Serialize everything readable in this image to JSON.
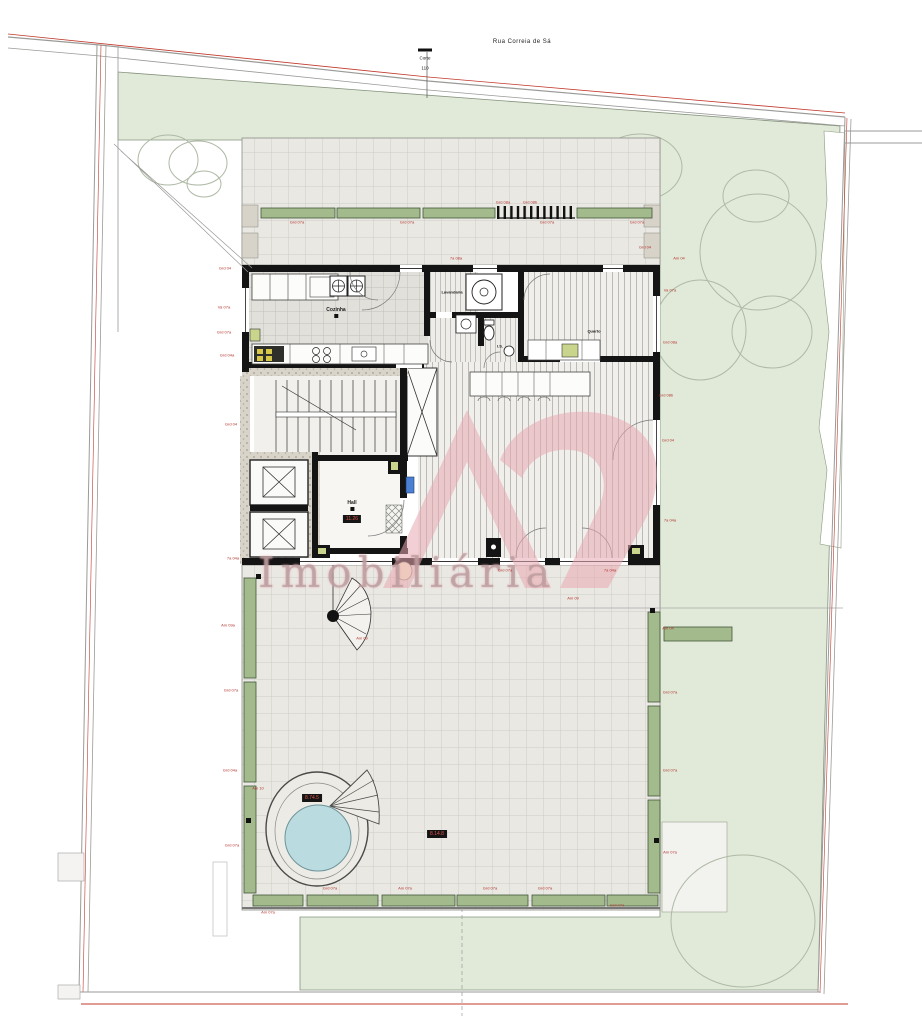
{
  "header": {
    "street_name": "Rua Correia de Sá",
    "section_marker": {
      "label": "Corte",
      "number": "110"
    }
  },
  "watermark": {
    "logo": "AS",
    "text": "Imobiliária",
    "color": "#e8a7b0"
  },
  "rooms": {
    "kitchen": "Cozinha",
    "laundry": "Lavandaria",
    "bedroom": "Quarto",
    "hall": "Hall",
    "wc": "I.S."
  },
  "boxed_labels": {
    "hall_area": "11.26",
    "pool_deck": "8.74.5",
    "terrace": "8.14.8"
  },
  "colors": {
    "garden_green": "#e1ead9",
    "planter_green": "#a3ba8c",
    "tile_grey": "#eae8e3",
    "wall_black": "#141414",
    "boundary_red": "#c0392b",
    "pool_water": "#badbdf",
    "dim_red": "#b3342e",
    "watermark_pink": "#e8a7b0"
  },
  "dims": [
    {
      "text": "Grd 04"
    },
    {
      "text": "Va 07a"
    },
    {
      "text": "Grd 07a"
    },
    {
      "text": "Grd 04a"
    },
    {
      "text": "Grd 04"
    },
    {
      "text": "7a 04a"
    },
    {
      "text": "Grd 07a"
    },
    {
      "text": "Grd 07a"
    },
    {
      "text": "Grd 08a"
    },
    {
      "text": "Grd 07a"
    },
    {
      "text": "Grd 07a"
    },
    {
      "text": "Grd 04"
    },
    {
      "text": "7a 08a"
    },
    {
      "text": "Am 04"
    },
    {
      "text": "Va 07a"
    },
    {
      "text": "Grd 08a"
    },
    {
      "text": "Grd 08b"
    },
    {
      "text": "Grd 04"
    },
    {
      "text": "7a 04a"
    },
    {
      "text": "7a 04a"
    },
    {
      "text": "Grd 07a"
    },
    {
      "text": "Am 09a"
    },
    {
      "text": "Grd 07a"
    },
    {
      "text": "Grd 04a"
    },
    {
      "text": "Grd 07a"
    },
    {
      "text": "Am 10"
    },
    {
      "text": "Grd 07a"
    },
    {
      "text": "Am 07a"
    },
    {
      "text": "Grd 07a"
    },
    {
      "text": "Grd 07a"
    },
    {
      "text": "Grd 07a"
    },
    {
      "text": "Am 07a"
    },
    {
      "text": "Am 04"
    },
    {
      "text": "Grd 07a"
    },
    {
      "text": "Grd 07a"
    },
    {
      "text": "Am 07a"
    },
    {
      "text": "Am 09"
    },
    {
      "text": "Am 09"
    },
    {
      "text": "Grd 08b"
    }
  ]
}
